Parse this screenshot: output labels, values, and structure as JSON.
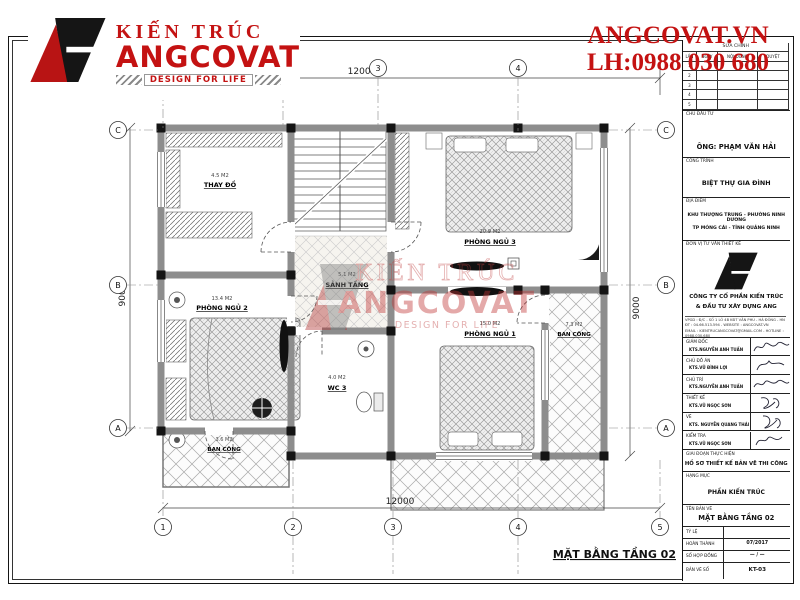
{
  "brand": {
    "logo_top": "KIẾN TRÚC",
    "logo_main": "ANGCOVAT",
    "logo_tagline": "DESIGN FOR LIFE",
    "site": "ANGCOVAT.VN",
    "phone": "LH:0988 030 680"
  },
  "watermark": {
    "line1": "KIẾN TRÚC",
    "line2": "ANGCOVAT",
    "line3": "DESIGN FOR LIFE"
  },
  "plan": {
    "title": "MẶT BẰNG TẦNG 02",
    "rooms": [
      {
        "name": "THAY ĐỒ",
        "area": "4.5 M2"
      },
      {
        "name": "PHÒNG NGỦ 2",
        "area": "13.4 M2"
      },
      {
        "name": "SẢNH TẦNG",
        "area": "5.1 M2"
      },
      {
        "name": "WC 3",
        "area": "4.0 M2"
      },
      {
        "name": "PHÒNG NGỦ 3",
        "area": "20.9 M2"
      },
      {
        "name": "PHÒNG NGỦ 1",
        "area": "15.0 M2"
      },
      {
        "name": "BAN CÔNG",
        "area": "7.3 M2"
      },
      {
        "name": "BAN CÔNG",
        "area": "3.6 M2"
      }
    ],
    "dimensions": {
      "top": "12000",
      "bottom": "12000",
      "left": "9000",
      "right": "9000"
    },
    "grid_columns": [
      "1",
      "2",
      "3",
      "4",
      "5"
    ],
    "grid_rows": [
      "C",
      "B",
      "A"
    ]
  },
  "titleblock": {
    "revisions": {
      "title": "SỬA CHÍNH",
      "columns": [
        "LẦN",
        "NGÀY",
        "NỘI DUNG",
        "DUYỆT"
      ],
      "row_numbers": [
        "1",
        "2",
        "3",
        "4",
        "5"
      ]
    },
    "investor_label": "CHỦ ĐẦU TƯ",
    "investor": "ÔNG: PHẠM VĂN HẢI",
    "project_label": "CÔNG TRÌNH",
    "project": "BIỆT THỰ GIA ĐÌNH",
    "location_label": "ĐỊA ĐIỂM",
    "location_line1": "KHU THƯỢNG TRUNG - PHƯỜNG NINH DƯƠNG",
    "location_line2": "TP MÓNG CÁI - TỈNH QUẢNG NINH",
    "consultant_label": "ĐƠN VỊ TƯ VẤN THIẾT KẾ",
    "company_line1": "CÔNG TY CỔ PHẦN KIẾN TRÚC",
    "company_line2": "& ĐẦU TƯ XÂY DỰNG   ANG",
    "address_line1": "VPGD : Đ/C - SỐ 1 LÔ 4B KĐT VĂN PHÚ - HÀ ĐÔNG - HN",
    "address_line2": "ĐT : 04.66.513.594 - WEBSITE : ANGCOVAT.VN",
    "address_line3": "EMAIL : KIENTRUCANGCOVAT@GMAIL.COM - HOTLINE : 0988.030.680",
    "signatures": [
      {
        "role": "GIÁM ĐỐC",
        "name": "KTS.NGUYỄN ANH TUẤN"
      },
      {
        "role": "CHỦ ĐỒ ÁN",
        "name": "KTS.VŨ ĐÌNH LỢI"
      },
      {
        "role": "CHỦ TRÌ",
        "name": "KTS.NGUYỄN ANH TUẤN"
      },
      {
        "role": "THIẾT KẾ",
        "name": "KTS.VŨ NGỌC SƠN"
      },
      {
        "role": "VẼ",
        "name": "KTS. NGUYỄN QUANG THÁI"
      },
      {
        "role": "KIỂM TRA",
        "name": "KTS.VŨ NGỌC SƠN"
      }
    ],
    "phase_label": "GIAI ĐOẠN THỰC HIỆN",
    "phase": "HỒ SƠ THIẾT KẾ BẢN VẼ THI CÔNG",
    "category_label": "HẠNG MỤC",
    "category": "PHẦN KIẾN TRÚC",
    "drawing_name_label": "TÊN BẢN VẼ",
    "drawing_name": "MẶT BẰNG TẦNG 02",
    "info_rows": [
      {
        "label": "TỶ LỆ",
        "value": ""
      },
      {
        "label": "HOÀN THÀNH",
        "value": "07/2017"
      },
      {
        "label": "SỐ HỢP ĐỒNG",
        "value": "— / —"
      },
      {
        "label": "BẢN VẼ SỐ",
        "value": "KT-03"
      }
    ]
  },
  "colors": {
    "brand_red": "#c41212",
    "wall_gray": "#8d8d8d",
    "line_dark": "#2a2a2a"
  }
}
